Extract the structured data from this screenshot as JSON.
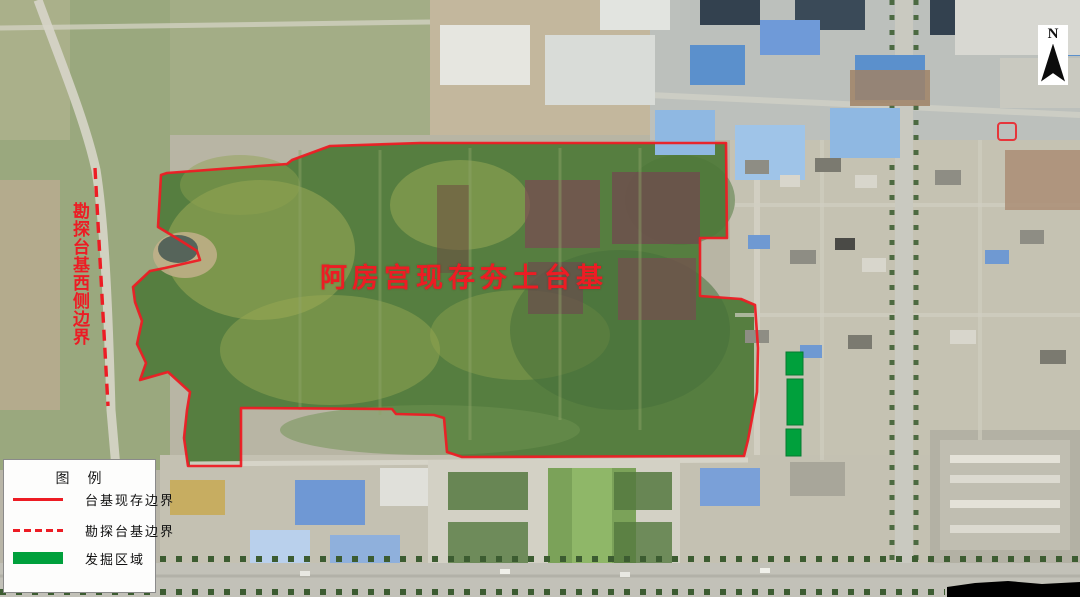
{
  "map": {
    "main_label": "阿房宫现存夯土台基",
    "west_boundary_label": "勘探台基西侧边界",
    "colors": {
      "boundary_red": "#ed1c24",
      "excavation_green": "#00a03c"
    }
  },
  "legend": {
    "title": "图　例",
    "items": [
      {
        "swatch": "red-solid-line",
        "label": "台基现存边界"
      },
      {
        "swatch": "red-dashed-line",
        "label": "勘探台基边界"
      },
      {
        "swatch": "green-filled-rect",
        "label": "发掘区域"
      }
    ]
  },
  "compass": {
    "label": "N"
  }
}
